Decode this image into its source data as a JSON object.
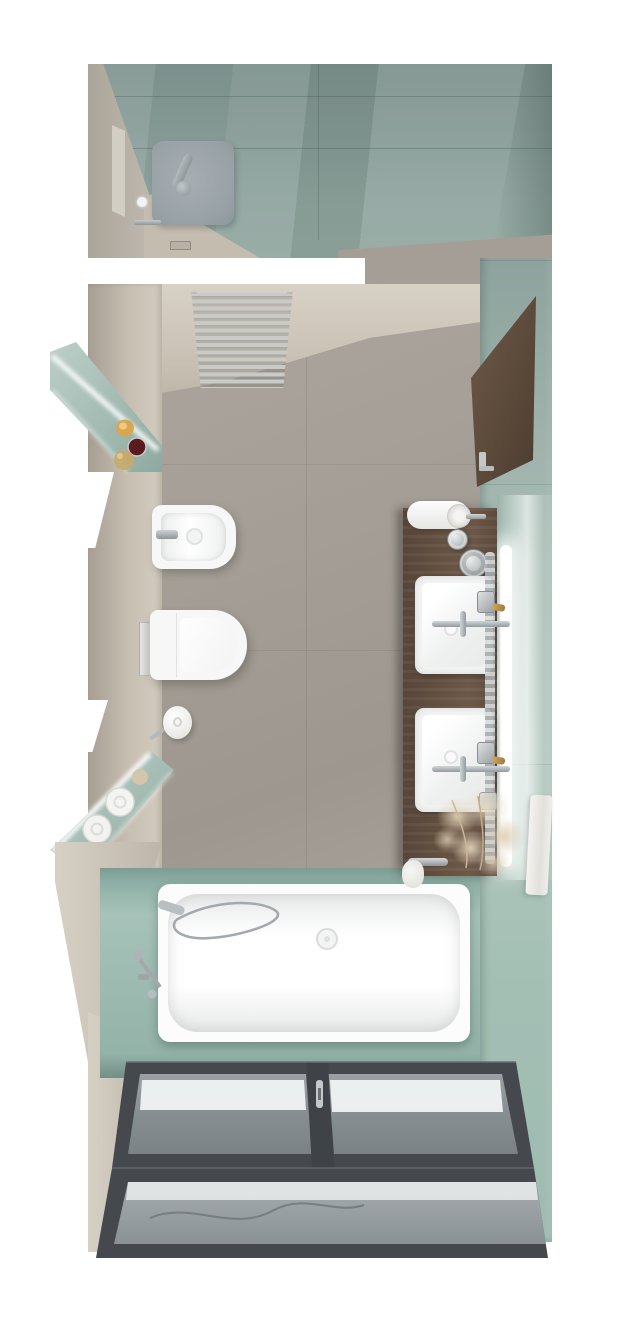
{
  "scene": {
    "title": "Top-down 3D render of a long narrow bathroom",
    "view": "top-down interior visualization",
    "room": "bathroom"
  },
  "palette": {
    "floor": "#a49e96",
    "wall": "#c9c1b4",
    "wall_dark": "#b0a89b",
    "teal": "#9bb3ab",
    "teal_dark": "#839893",
    "teal_light": "#b4c8c0",
    "deck": "#a2bfb4",
    "white_fixture": "#f6f7f6",
    "chrome": "#b4b9bb",
    "chrome_dark": "#8f9497",
    "wood": "#63503f",
    "frame": "#45494e",
    "glass": "#91989b",
    "glass_light": "#eef0f0",
    "led": "#ffffff",
    "plant": "#dccdb8",
    "candle": "#d9a84e",
    "jar_red": "#5a1b20",
    "gold": "#c9a86a"
  },
  "objects": {
    "shower": "walk-in shower with square rain head",
    "radiator": "ladder towel radiator",
    "bidet": "wall-hung bidet",
    "toilet": "wall-hung toilet with closed lid",
    "flush_plate": "toilet flush plate",
    "paper_holder": "toilet paper holder",
    "upper_niche": "LED-lit teal shelf niche with candle, jar and dried flowers",
    "lower_niche": "LED-lit teal niche with rolled towels",
    "vanity": "dark wood vanity counter",
    "basins": "two square countertop washbasins",
    "faucets": "wall-mounted chrome faucets with gold handles",
    "mirror": "mirror with LED strip",
    "cabinet": "tall wooden cabinet door",
    "plant": "pampas grass arrangement",
    "bathtub": "built-in rectangular bathtub",
    "hand_shower": "handheld shower with hose",
    "glass_wall": "anthracite framed glass wall with double doors"
  }
}
